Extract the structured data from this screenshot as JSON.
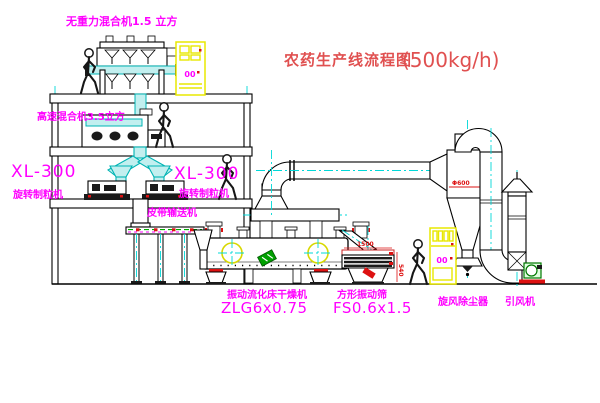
{
  "title": {
    "text": "农药生产线流程图",
    "capacity": "(500kg/h)"
  },
  "labels": {
    "top_mixer": "无重力混合机1.5 立方",
    "mid_mixer": "高速混合机3.5立方",
    "granulator_left": {
      "model": "XL-300",
      "name": "旋转制粒机"
    },
    "granulator_right": {
      "model": "XL-300",
      "name": "旋转制粒机"
    },
    "conveyor": "皮带输送机",
    "dryer": {
      "name": "振动流化床干燥机",
      "model": "ZLG6x0.75"
    },
    "sieve": {
      "name": "方形振动筛",
      "model": "FS0.6x1.5"
    },
    "cyclone": "旋风除尘器",
    "fan": "引风机"
  },
  "dimensions": {
    "sieve_length": "1500",
    "sieve_height": "540",
    "cyclone_diameter": "Φ600"
  },
  "cabinets": {
    "display": "00"
  },
  "colors": {
    "label_magenta": "#ff00ff",
    "title_red": "#e05050",
    "dimension_red": "#dd1111",
    "centerline_cyan": "#00d8d8",
    "pipe_cyan_fill": "#c2efef",
    "cabinet_yellow": "#e8e800",
    "motor_yellow": "#d8d800",
    "logo_green": "#00a000",
    "belt_green": "#00aa00",
    "line_black": "#000000"
  }
}
